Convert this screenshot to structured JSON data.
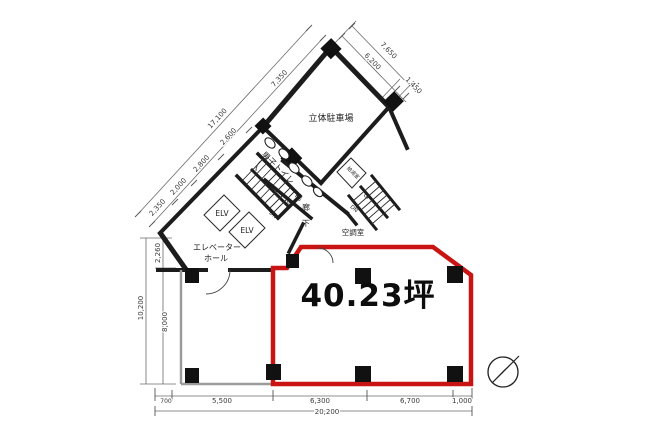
{
  "floorplan": {
    "title": "office-floor-plan",
    "area_label": "40.23坪",
    "rooms": {
      "parking": "立体駐車場",
      "mens_toilet": "男子トイレ",
      "kitchenette": "給湯室",
      "hvac_room": "空調室",
      "pipe_space": "PS",
      "corridor_char1": "廊",
      "corridor_char2": "下",
      "elevator_hall_line1": "エレベーター",
      "elevator_hall_line2": "ホール",
      "elv1": "ELV",
      "elv2": "ELV",
      "stairs_main_up": "UP",
      "stairs_main_dn": "DN",
      "stairs_upper_up": "UP",
      "stairs_upper_dn": "DN"
    },
    "dims": {
      "ne": {
        "outer": "7,650",
        "inner": "6,200",
        "end": "1,450"
      },
      "nw": {
        "total": "17,100",
        "segs": [
          "2,350",
          "2,000",
          "2,800",
          "2,600",
          "7,350"
        ]
      },
      "left": {
        "upper": "2,260",
        "total": "10,200",
        "lower": "8,000"
      },
      "bottom": {
        "total": "20,200",
        "segs": [
          "700",
          "5,500",
          "6,300",
          "6,700",
          "1,000"
        ]
      }
    },
    "colors": {
      "unit_outline": "#c91414",
      "walls": "#1c1c1c"
    },
    "compass": "north-arrow"
  }
}
